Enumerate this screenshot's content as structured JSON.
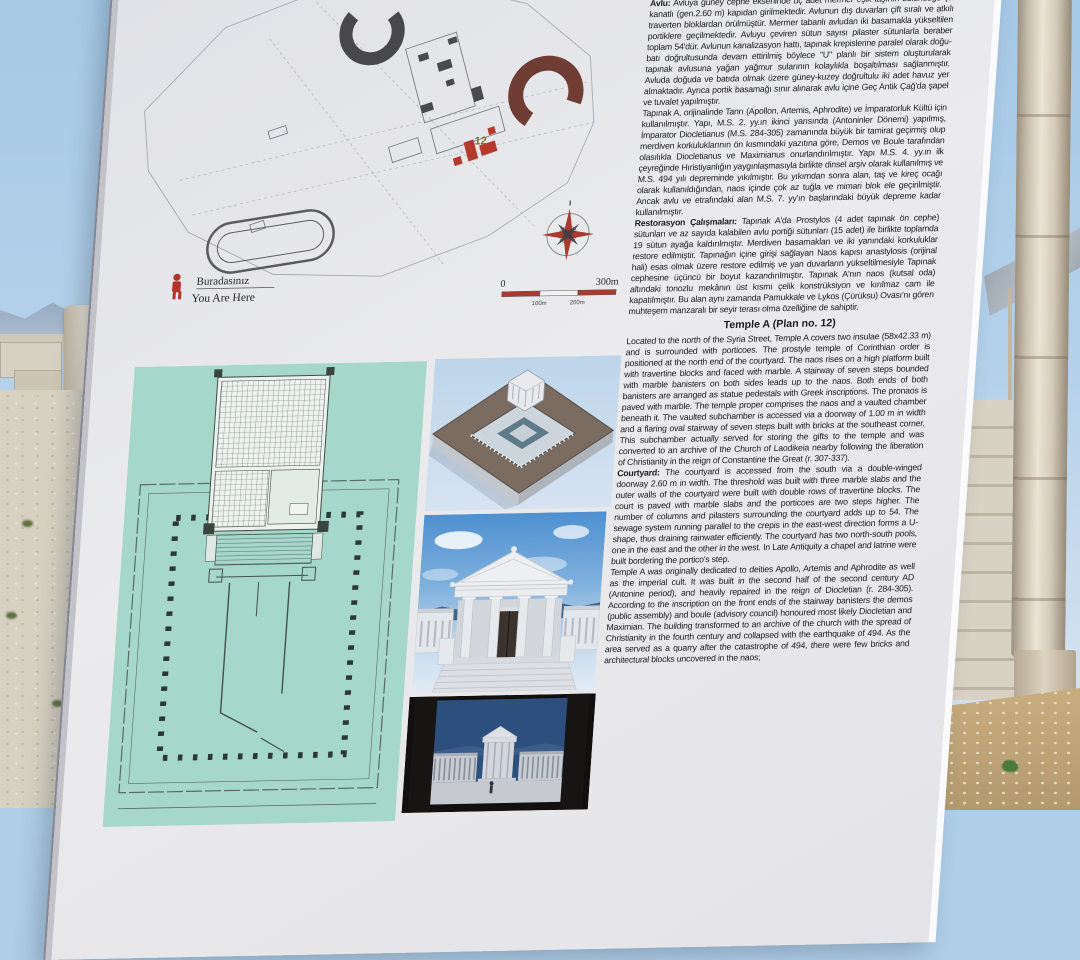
{
  "colors": {
    "sky": "#aecde6",
    "sign_face": "#e7e7ea",
    "teal_panel": "#a6d7cb",
    "map_accent_red": "#a83a2e",
    "column_stone": "#d3c9b8",
    "render_sky": "#4e90d0",
    "text": "#1c1c1f"
  },
  "sign": {
    "map": {
      "plan_number_label": "12",
      "you_are_here_tr": "Buradasınız",
      "you_are_here_en": "You Are Here",
      "scale": {
        "zero": "0",
        "end": "300m",
        "mid1": "100m",
        "mid2": "200m"
      }
    },
    "turkish": {
      "fragment": "birlikte, dinsel arşiv odası olarak işlevi devam etmiştir.",
      "p1_lead": "Avlu:",
      "p1": "Avluya güney cephe ekseninde üç adet mermer eşik taşının bulunduğu çift kanatlı (gen.2.60 m) kapıdan girilmektedir. Avlunun dış duvarları çift sıralı ve atkılı traverten bloklardan örülmüştür. Mermer tabanlı avludan iki basamakla yükseltilen portiklere geçilmektedir. Avluyu çeviren sütun sayısı pilaster sütunlarla beraber toplam 54'dür. Avlunun kanalizasyon hattı, tapınak krepislerine paralel olarak doğu-batı doğrultusunda devam ettirilmiş böylece \"U\" planlı bir sistem oluşturularak tapınak avlusuna yağan yağmur sularının kolaylıkla boşaltılması sağlanmıştır. Avluda doğuda ve batıda olmak üzere güney-kuzey doğrultulu iki adet havuz yer almaktadır. Ayrıca portik basamağı sınır alınarak avlu içine Geç Antik Çağ'da şapel ve tuvalet yapılmıştır.",
      "p2": "Tapınak A, orijinalinde Tanrı (Apollon, Artemis, Aphrodite) ve İmparatorluk Kültü için kullanılmıştır. Yapı, M.S. 2. yy.ın ikinci yarısında (Antoninler Dönemi) yapılmış, İmparator Diocletianus (M.S. 284-305) zamanında büyük bir tamirat geçirmiş olup merdiven korkuluklarının ön kısmındaki yazıtına göre, Demos ve Boule tarafından olasılıkla Diocletianus ve Maximianus onurlandırılmıştır. Yapı M.S. 4. yy.ın ilk çeyreğinde Hıristiyanlığın yaygınlaşmasıyla birlikte dinsel arşiv olarak kullanılmış ve M.S. 494 yılı depreminde yıkılmıştır. Bu yıkımdan sonra alan, taş ve kireç ocağı olarak kullanıldığından, naos içinde çok az tuğla ve mimari blok ele geçirilmiştir. Ancak avlu ve etrafındaki alan M.S. 7. yy'ın başlarındaki büyük depreme kadar kullanılmıştır.",
      "p3_lead": "Restorasyon Çalışmaları:",
      "p3": "Tapınak A'da Prostylos (4 adet tapınak ön cephe) sütunları ve az sayıda kalabilen avlu portiği sütunları (15 adet) ile birlikte toplamda 19 sütun ayağa kaldırılmıştır. Merdiven basamakları ve iki yanındaki korkuluklar restore edilmiştir. Tapınağın içine girişi sağlayan Naos kapısı anastylosis (orijinal hali) esas olmak üzere restore edilmiş ve yan duvarların yükseltilmesiyle Tapınak cephesine üçüncü bir boyut kazandırılmıştır. Tapınak A'nın naos (kutsal oda) altındaki tonozlu mekânın üst kısmı çelik konstrüksiyon ve kırılmaz cam ile kapatılmıştır. Bu alan aynı zamanda Pamukkale ve Lykos (Çürüksu) Ovası'nı gören muhteşem manzaralı bir seyir terası olma özelliğine de sahiptir."
    },
    "english": {
      "heading": "Temple A (Plan no. 12)",
      "p1": "Located to the north of the Syria Street, Temple A covers two insulae (58x42.33 m) and is surrounded with porticoes. The prostyle temple of Corinthian order is positioned at the north end of the courtyard. The naos rises on a high platform built with travertine blocks and faced with marble. A stairway of seven steps bounded with marble banisters on both sides leads up to the naos. Both ends of both banisters are arranged as statue pedestals with Greek inscriptions. The pronaos is paved with marble. The temple proper comprises the naos and a vaulted chamber beneath it. The vaulted subchamber is accessed via a doorway of 1.00 m in width and a flaring oval stairway of seven steps built with bricks at the southeast corner. This subchamber actually served for storing the gifts to the temple and was converted to an archive of the Church of Laodikeia nearby following the liberation of Christianity in the reign of Constantine the Great (r. 307-337).",
      "p2_lead": "Courtyard:",
      "p2": "The courtyard is accessed from the south via a double-winged doorway 2.60 m in width. The threshold was built with three marble slabs and the outer walls of the courtyard were built with double rows of travertine blocks. The court is paved with marble slabs and the porticoes are two steps higher. The number of columns and pilasters surrounding the courtyard adds up to 54. The sewage system running parallel to the crepis in the east-west direction forms a U-shape, thus draining rainwater efficiently. The courtyard has two north-south pools, one in the east and the other in the west. In Late Antiquity a chapel and latrine were built bordering the portico's step.",
      "p3": "Temple A was originally dedicated to deities Apollo, Artemis and Aphrodite as well as the imperial cult. It was built in the second half of the second century AD (Antonine period), and heavily repaired in the reign of Diocletian (r. 284-305). According to the inscription on the front ends of the stairway banisters the demos (public assembly) and boule (advisory council) honoured most likely Diocletian and Maximian. The building transformed to an archive of the church with the spread of Christianity in the fourth century and collapsed with the earthquake of 494. As the area served as a quarry after the catastrophe of 494, there were few bricks and architectural blocks uncovered in the naos;"
    }
  }
}
